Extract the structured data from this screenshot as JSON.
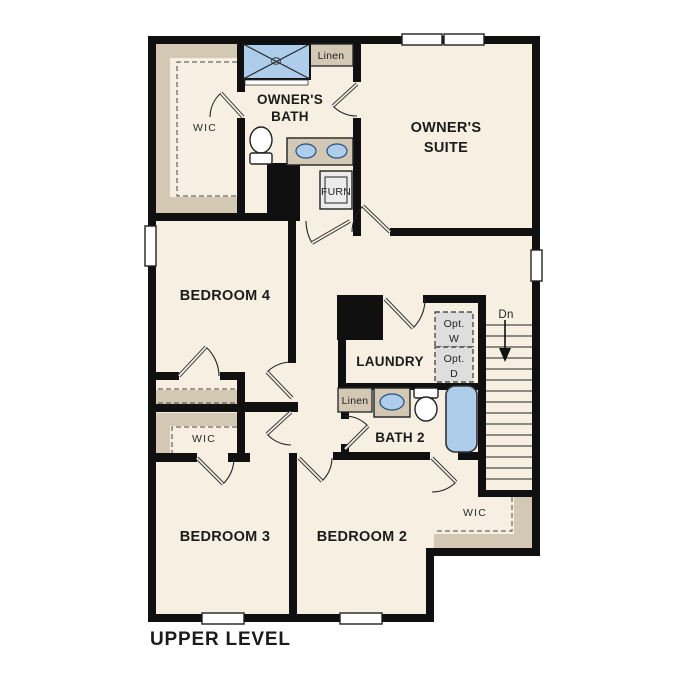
{
  "plan_name": "Upper level floor plan",
  "footer": {
    "title": "UPPER LEVEL"
  },
  "colors": {
    "floor": "#f7f0e2",
    "wall": "#101010",
    "shelving": "#d3c8b4",
    "fixture_blue": "#adcdeb",
    "optional_fill": "#dedede",
    "text": "#1b1b1b"
  },
  "rooms": {
    "owners_suite": {
      "line1": "OWNER'S",
      "line2": "SUITE"
    },
    "owners_bath": {
      "line1": "OWNER'S",
      "line2": "BATH"
    },
    "wic_top_left": {
      "label": "WIC"
    },
    "linen_top": {
      "label": "Linen"
    },
    "furnace": {
      "label": "FURN"
    },
    "bedroom4": {
      "label": "BEDROOM 4"
    },
    "laundry": {
      "label": "LAUNDRY"
    },
    "opt_washer": {
      "line1": "Opt.",
      "line2": "W"
    },
    "opt_dryer": {
      "line1": "Opt.",
      "line2": "D"
    },
    "stairs": {
      "down_label": "Dn"
    },
    "linen_bath2": {
      "label": "Linen"
    },
    "bath2": {
      "label": "BATH 2"
    },
    "wic_middle": {
      "label": "WIC"
    },
    "wic_bedroom2": {
      "label": "WIC"
    },
    "bedroom3": {
      "label": "BEDROOM 3"
    },
    "bedroom2": {
      "label": "BEDROOM 2"
    }
  }
}
